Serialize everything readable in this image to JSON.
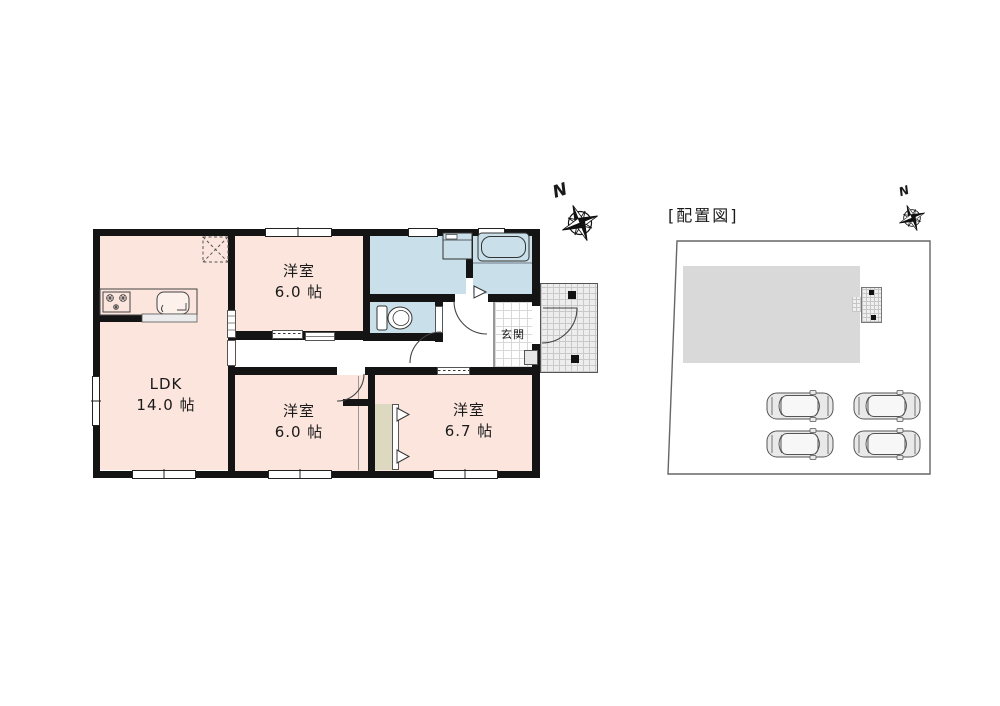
{
  "floor_plan": {
    "compass": {
      "label": "N"
    },
    "rooms": {
      "ldk": {
        "label": "LDK",
        "size": "14.0 帖"
      },
      "bedroom_north": {
        "label": "洋室",
        "size": "6.0 帖"
      },
      "bedroom_south": {
        "label": "洋室",
        "size": "6.0 帖"
      },
      "bedroom_east": {
        "label": "洋室",
        "size": "6.7 帖"
      },
      "entrance": {
        "label": "玄関"
      }
    }
  },
  "site_plan": {
    "title": "[配置図]",
    "compass": {
      "label": "N"
    },
    "car_count": 4
  },
  "colors": {
    "room_pink": "#fbe5dd",
    "wet_area_blue": "#c9dfe9",
    "closet_tan": "#ddd8c0",
    "wall_black": "#141414",
    "building_gray": "#d9d9d9",
    "porch_gray": "#ededed"
  }
}
